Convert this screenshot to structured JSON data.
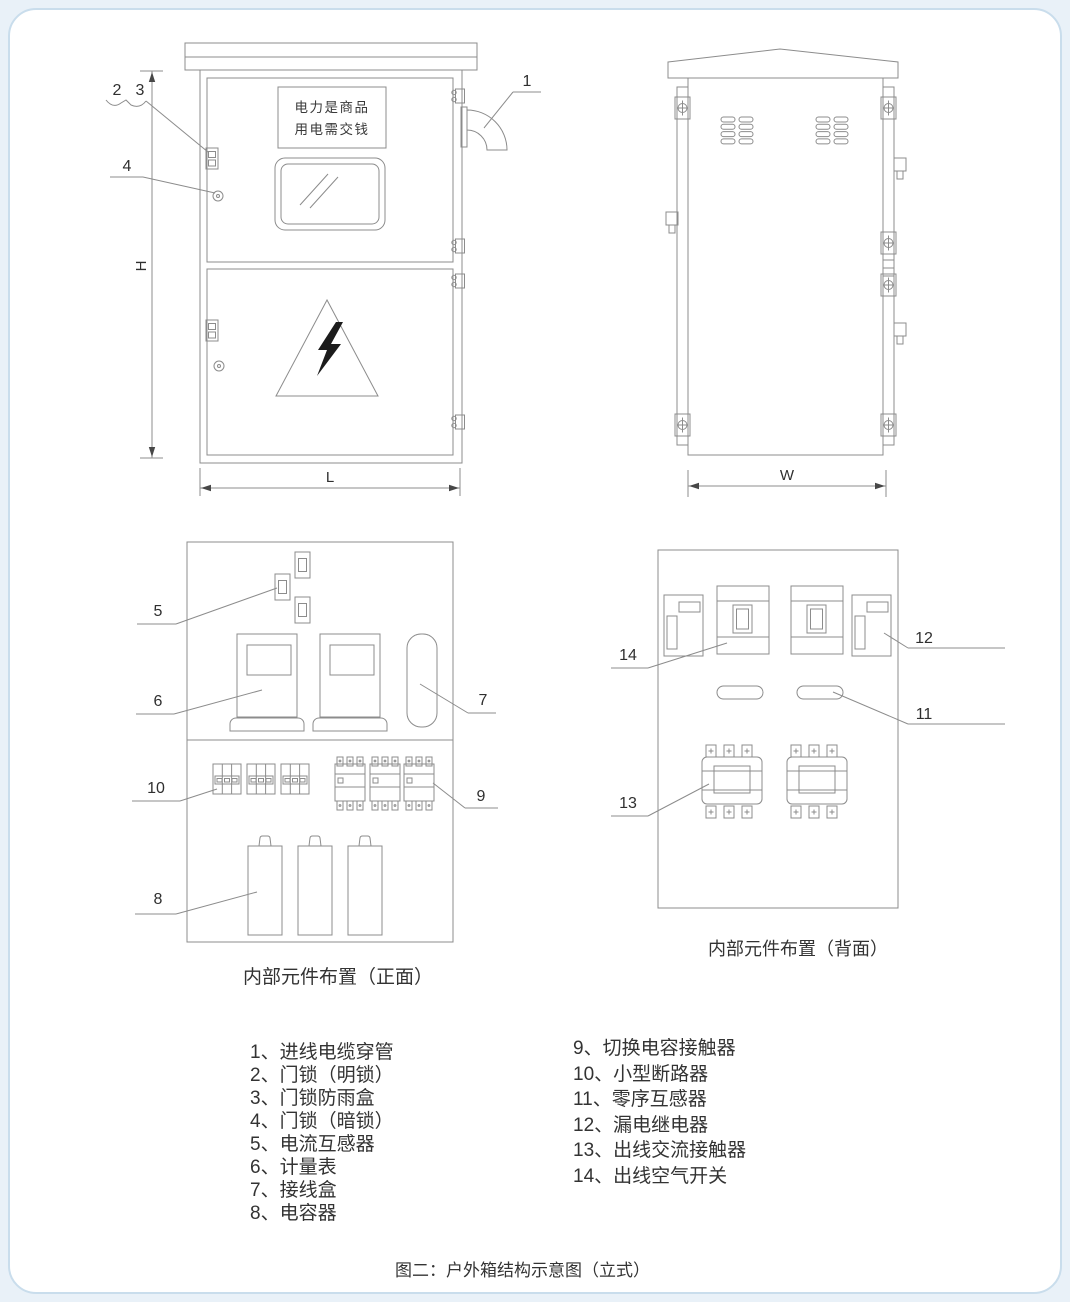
{
  "figure_caption": "图二：户外箱结构示意图（立式）",
  "front_view": {
    "sign_line1": "电力是商品",
    "sign_line2": "用电需交钱",
    "dim_h": "H",
    "dim_l": "L",
    "callout_1": "1",
    "callout_2": "2",
    "callout_3": "3",
    "callout_4": "4"
  },
  "side_view": {
    "dim_w": "W"
  },
  "front_layout": {
    "caption": "内部元件布置（正面）",
    "callout_5": "5",
    "callout_6": "6",
    "callout_7": "7",
    "callout_8": "8",
    "callout_9": "9",
    "callout_10": "10"
  },
  "back_layout": {
    "caption": "内部元件布置（背面）",
    "callout_11": "11",
    "callout_12": "12",
    "callout_13": "13",
    "callout_14": "14"
  },
  "legend": {
    "left": [
      "1、进线电缆穿管",
      "2、门锁（明锁）",
      "3、门锁防雨盒",
      "4、门锁（暗锁）",
      "5、电流互感器",
      "6、计量表",
      "7、接线盒",
      "8、电容器"
    ],
    "right": [
      "9、切换电容接触器",
      "10、小型断路器",
      "11、零序互感器",
      "12、漏电继电器",
      "13、出线交流接触器",
      "14、出线空气开关"
    ]
  },
  "colors": {
    "page_background": "#e9f1f8",
    "card_border": "#c9ddec",
    "line_art": "#8c8c8c",
    "text": "#2f2f2f"
  }
}
